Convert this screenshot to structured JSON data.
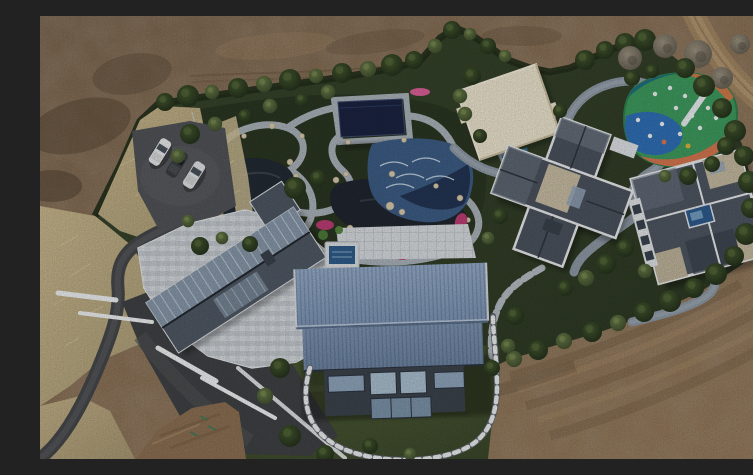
{
  "meta": {
    "type": "aerial-drone-photograph",
    "description": "Top-down aerial photograph of a landscaped private estate compound surrounded by bare brown construction dirt",
    "no_visible_text": true,
    "width_px": 753,
    "height_px": 443
  },
  "scene": {
    "ground": {
      "dirt_color": "#83694f",
      "lawn_color": "#3f4c2d",
      "dry_grass_color": "#c0b087",
      "asphalt_road_color": "#46474a",
      "dirt_road_color": "#a18662"
    },
    "perimeter": {
      "hedge_color": "#222e1a",
      "tree_colors": [
        "#1f2a18",
        "#39462a",
        "#5c564a"
      ]
    },
    "vehicles": {
      "count": 3,
      "colors": [
        "#e8e9ea",
        "#3a3d40",
        "#dfe1e2"
      ],
      "location": "parking pad upper left"
    },
    "buildings": [
      {
        "name": "west-building",
        "roof_color": "#4f5864",
        "glass_color": "#8fa1b4",
        "feature": "diagonal gable roof with glass skylights and light stone mosaic terrace"
      },
      {
        "name": "blue-barn",
        "roof_color": "#889ec0",
        "wall_color": "#3c434b",
        "feature": "large standing-seam steel-blue gable roof, glazed south wall"
      },
      {
        "name": "middle-villa",
        "roof_color": "#4b525d",
        "trim_color": "#e6e8ea",
        "flat_roof_color": "#c6bba2",
        "feature": "cross-plan slate hip roof with white parapets"
      },
      {
        "name": "east-villa",
        "roof_color": "#4e5661",
        "trim_color": "#e8eaec",
        "pool_color": "#2d5b8c",
        "feature": "square pinwheel roof with central skylight pool"
      },
      {
        "name": "cream-pavilion-roof",
        "roof_color": "#eae2cc"
      },
      {
        "name": "pergola-pool-cover",
        "color": "#1b2340"
      }
    ],
    "water_features": [
      {
        "name": "koi-pond-west",
        "color": "#232a33"
      },
      {
        "name": "koi-pond-east",
        "color": "#20262f"
      },
      {
        "name": "wave-pool",
        "color": "#3c5c84",
        "ripple_color": "#d7e5ee"
      },
      {
        "name": "plunge-pool",
        "color": "#2f5c8a"
      }
    ],
    "playground": {
      "colors": [
        "#3e9a5e",
        "#2f6fb5",
        "#d4764f",
        "#1f6f80",
        "#27476e"
      ],
      "equipment_color": "#eef1f3"
    },
    "paths": {
      "garden_path_color": "#a9b1b8",
      "loop_path_color": "#8d98a4",
      "checkered_path_colors": [
        "#e9ebec",
        "#5f666d"
      ]
    },
    "planting": {
      "azalea_color": "#bb3d74",
      "rock_color": "#d6c9ad"
    }
  }
}
